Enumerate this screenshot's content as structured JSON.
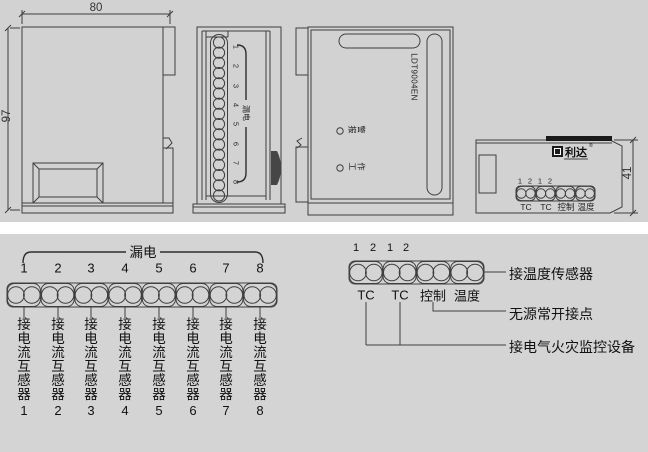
{
  "top_views": {
    "side": {
      "width_dim": "80",
      "height_dim": "97"
    },
    "back": {
      "numbers": [
        "1",
        "2",
        "3",
        "4",
        "5",
        "6",
        "7",
        "8"
      ],
      "group_label": "漏电"
    },
    "front": {
      "model": "LDT9004EN",
      "led1_chars": [
        "报",
        "警"
      ],
      "led2_chars": [
        "工",
        "作"
      ]
    },
    "top": {
      "brand": "利达",
      "reg_mark": "®",
      "height_dim": "41",
      "pin_numbers": [
        "1",
        "2",
        "1",
        "2"
      ],
      "port_labels": [
        "TC",
        "TC",
        "控制",
        "温度"
      ]
    }
  },
  "wiring_left": {
    "group_label": "漏电",
    "terminals": [
      {
        "num": "1",
        "label": "接电流互感器"
      },
      {
        "num": "2",
        "label": "接电流互感器"
      },
      {
        "num": "3",
        "label": "接电流互感器"
      },
      {
        "num": "4",
        "label": "接电流互感器"
      },
      {
        "num": "5",
        "label": "接电流互感器"
      },
      {
        "num": "6",
        "label": "接电流互感器"
      },
      {
        "num": "7",
        "label": "接电流互感器"
      },
      {
        "num": "8",
        "label": "接电流互感器"
      }
    ]
  },
  "wiring_right": {
    "pin_numbers": [
      "1",
      "2",
      "1",
      "2"
    ],
    "port_labels": [
      "TC",
      "TC",
      "控制",
      "温度"
    ],
    "annotations": [
      "接温度传感器",
      "无源常开接点",
      "接电气火灾监控设备"
    ]
  }
}
